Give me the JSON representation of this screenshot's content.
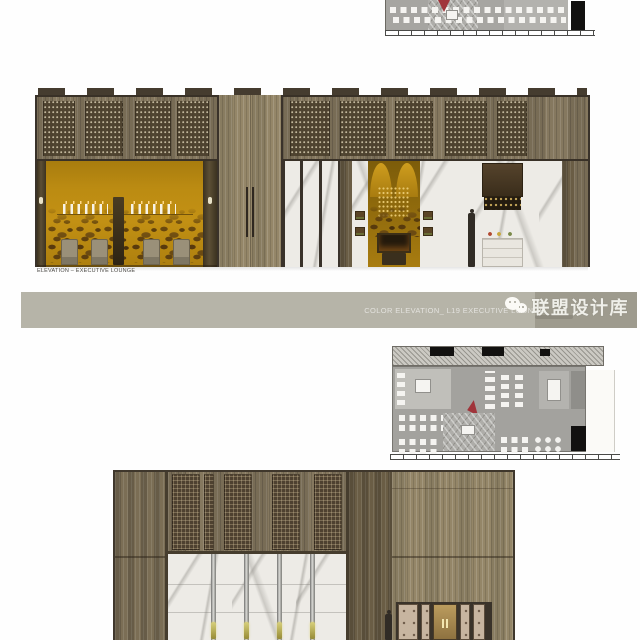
{
  "sheet": {
    "background": "#fefefe",
    "elevations": {
      "main": {
        "label": "ELEVATION – EXECUTIVE LOUNGE"
      }
    },
    "banner": {
      "title": "COLOR ELEVATION_ L19 EXECUTIVE LOUNGE",
      "bg": "#b6b4a8",
      "bg_dark": "#9e9b8e",
      "text_color": "rgba(255,255,255,0.62)"
    },
    "watermark": {
      "brand": "联盟设计库",
      "icon": "wechat-logo-icon"
    },
    "palette": {
      "gold_wall": "#bb8b12",
      "wood": "#85785f",
      "wood_dark": "#6a5d45",
      "marble": "#edebe6",
      "mosaic_brown": "#5a3a0e",
      "plan_floor_gray": "#a3a29e",
      "accent_red": "#a0343a",
      "banner_gray": "#b6b4a8"
    }
  }
}
